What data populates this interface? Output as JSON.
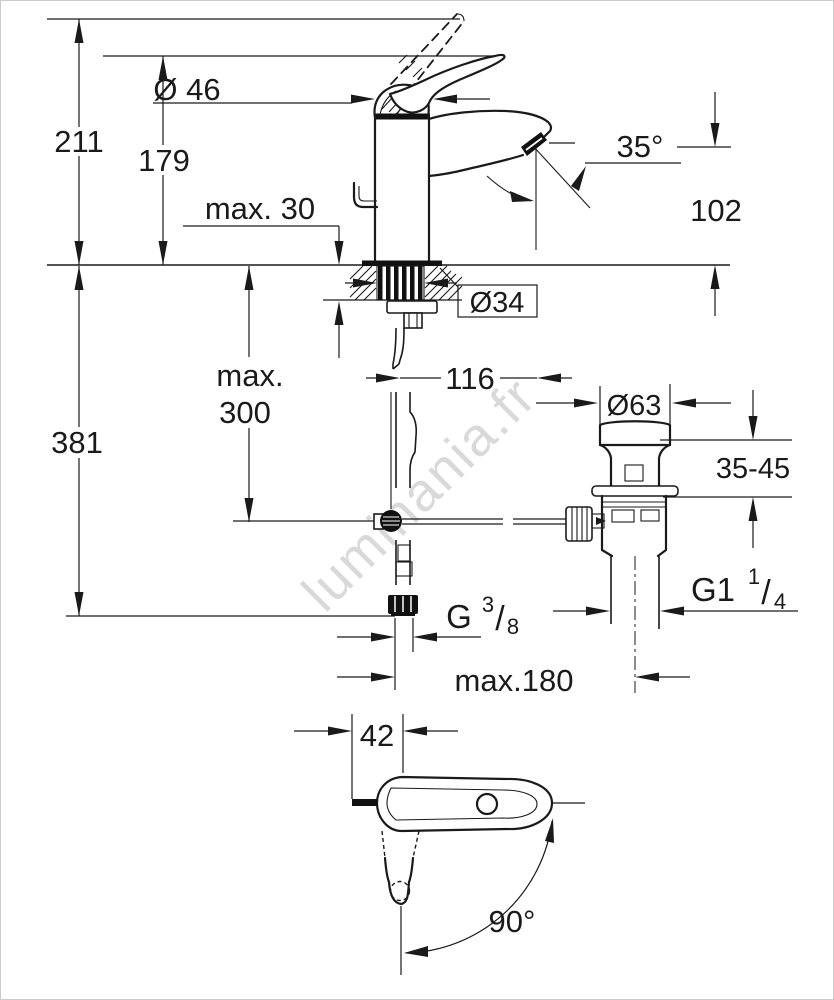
{
  "drawing": {
    "watermark": "luminania.fr",
    "colors": {
      "line": "#1a1a1a",
      "watermark": "#d9d9d9",
      "background": "#ffffff",
      "border": "#cccccc"
    },
    "labels": {
      "overall_height": "211",
      "height_to_lever_tip": "179",
      "cartridge_diameter": "Ø 46",
      "deck_thickness_max": "max. 30",
      "aerator_angle": "35°",
      "spout_height": "102",
      "mounting_hole_diameter": "Ø34",
      "spout_projection": "116",
      "rod_depth_max_line1": "max.",
      "rod_depth_max_line2": "300",
      "below_deck_depth": "381",
      "waste_flange_diameter": "Ø63",
      "waste_deck_range": "35-45",
      "supply_thread_prefix": "G",
      "supply_thread_numerator": "3",
      "supply_thread_slash": "/",
      "supply_thread_denominator": "8",
      "waste_thread_prefix": "G1",
      "waste_thread_numerator": "1",
      "waste_thread_slash": "/",
      "waste_thread_denominator": "4",
      "rod_reach_max": "max.180",
      "handle_width": "42",
      "swivel_angle": "90°"
    }
  }
}
